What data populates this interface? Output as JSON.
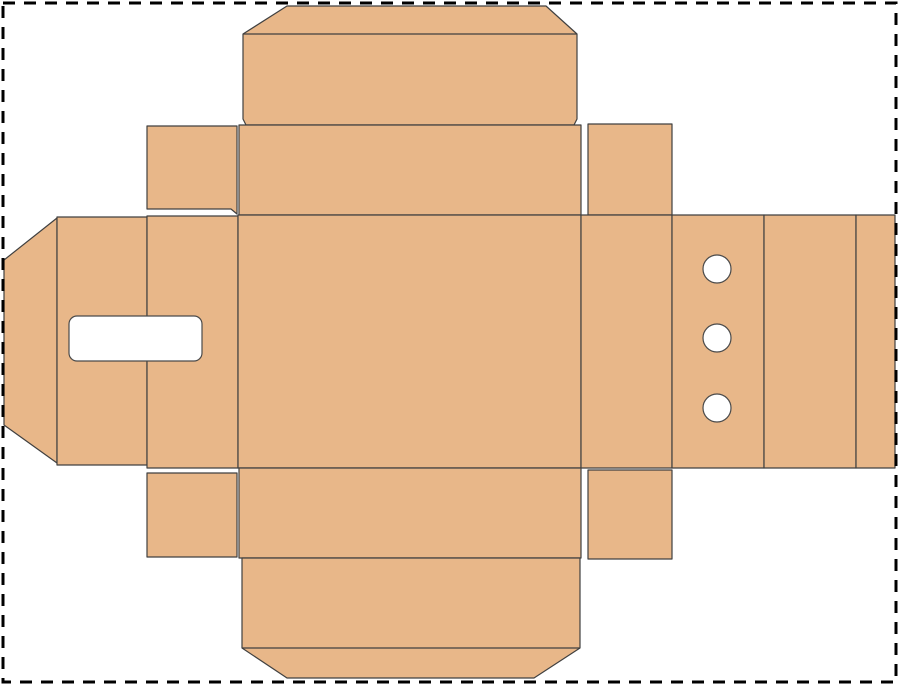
{
  "page": {
    "width": 900,
    "height": 687,
    "background_color": "#ffffff",
    "border": {
      "x": 3,
      "y": 3,
      "width": 893,
      "height": 679,
      "color": "#000000",
      "thickness": 3,
      "dash_pattern": "12 9"
    }
  },
  "dieline": {
    "kind": "box-packaging-dieline-template",
    "fill_color": "#e8b789",
    "stroke_color": "#404040",
    "stroke_width": 1.2,
    "panels": [
      {
        "name": "top-glue-flap",
        "points": "243,34 287,6 546,6 577,34 577,119 574,125 246,125 243,119"
      },
      {
        "name": "top-lid-panel",
        "points": "239,125 581,125 581,215 239,215"
      },
      {
        "name": "top-left-dust-flap",
        "points": "147,126 237,126 237,214 231,209 147,209"
      },
      {
        "name": "top-right-dust-flap",
        "points": "588,124 672,124 672,215 588,215"
      },
      {
        "name": "left-lock-tab",
        "points": "4,260 57,218 57,463 4,425"
      },
      {
        "name": "left-handle-panel",
        "points": "57,217 147,217 147,465 57,465"
      },
      {
        "name": "left-side-panel",
        "points": "147,216 238,216 238,468 147,468"
      },
      {
        "name": "main-panel",
        "points": "238,215 581,215 581,468 238,468"
      },
      {
        "name": "right-side-panel",
        "points": "581,215 672,215 672,468 581,468"
      },
      {
        "name": "vent-hole-panel",
        "points": "672,215 764,215 764,468 672,468"
      },
      {
        "name": "right-outer-panel",
        "points": "764,215 856,215 856,468 764,468"
      },
      {
        "name": "right-edge-strip",
        "points": "856,215 895,215 895,468 856,468"
      },
      {
        "name": "bottom-lid-panel",
        "points": "239,468 581,468 581,558 239,558"
      },
      {
        "name": "bottom-left-dust-flap",
        "points": "147,473 237,473 237,557 147,557"
      },
      {
        "name": "bottom-right-dust-flap",
        "points": "588,470 672,470 672,559 588,559"
      },
      {
        "name": "bottom-glue-flap",
        "points": "242,558 580,558 580,648 534,678 287,678 242,648"
      }
    ],
    "crease_lines": [
      {
        "name": "top-flap-crease",
        "x1": 243,
        "y1": 34,
        "x2": 577,
        "y2": 34
      },
      {
        "name": "bottom-flap-crease",
        "x1": 242,
        "y1": 648,
        "x2": 580,
        "y2": 648
      }
    ],
    "cutouts": {
      "fill_color": "#ffffff",
      "stroke_color": "#4a4a4a",
      "stroke_width": 1.2,
      "handle_slot": {
        "name": "handle-slot-cutout",
        "x": 69,
        "y": 316,
        "width": 133,
        "height": 45,
        "radius": 8
      },
      "circles": [
        {
          "name": "vent-hole-top",
          "cx": 717,
          "cy": 269,
          "r": 14
        },
        {
          "name": "vent-hole-middle",
          "cx": 717,
          "cy": 338,
          "r": 14
        },
        {
          "name": "vent-hole-bottom",
          "cx": 717,
          "cy": 408,
          "r": 14
        }
      ]
    }
  }
}
